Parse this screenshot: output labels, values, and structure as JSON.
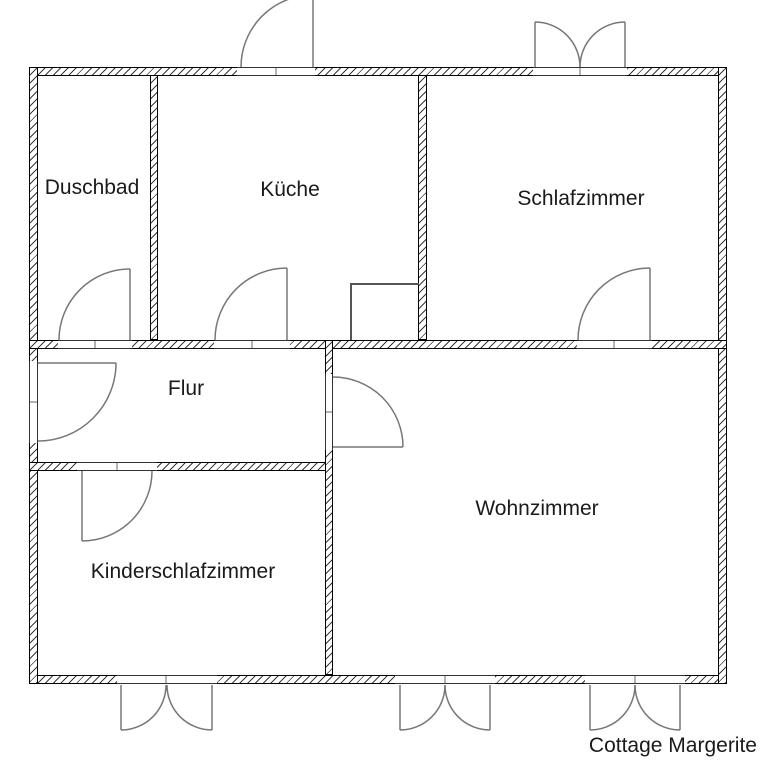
{
  "floor_plan": {
    "caption": "Cottage Margerite",
    "rooms": {
      "duschbad": {
        "label": "Duschbad"
      },
      "kueche": {
        "label": "Küche"
      },
      "schlafzimmer": {
        "label": "Schlafzimmer"
      },
      "flur": {
        "label": "Flur"
      },
      "kinderschlafzimmer": {
        "label": "Kinderschlafzimmer"
      },
      "wohnzimmer": {
        "label": "Wohnzimmer"
      }
    },
    "colors": {
      "background": "#ffffff",
      "wall_border": "#000000",
      "wall_hatch": "#3a3a3a",
      "threshold_line": "#333333",
      "threshold_tick": "#b3b3b3",
      "door_stroke": "#777777",
      "fixture_stroke": "#555555",
      "text": "#1a1a1a"
    }
  }
}
